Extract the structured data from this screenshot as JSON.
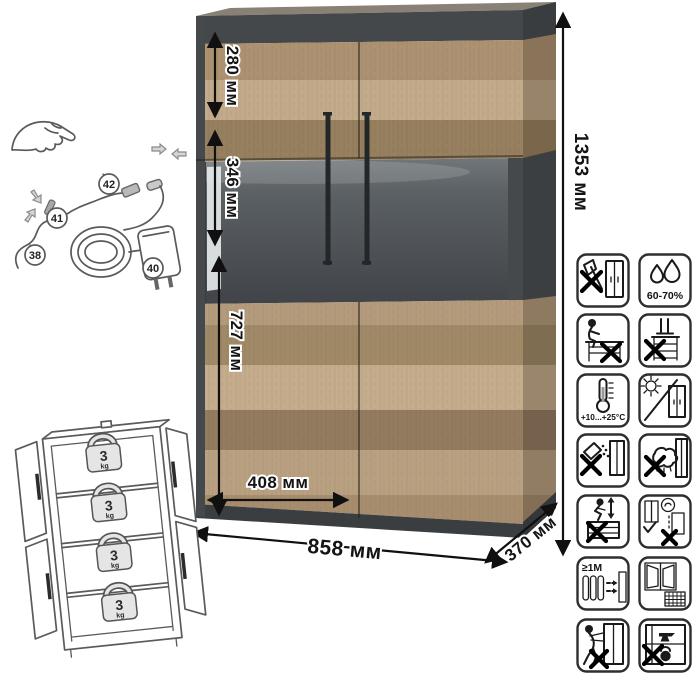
{
  "dimensions": {
    "top_section_height": "280 мм",
    "display_section_height": "346 мм",
    "lower_section_height": "727 мм",
    "door_width": "408 мм",
    "total_width": "858 мм",
    "depth": "370 мм",
    "total_height": "1353 мм"
  },
  "led_kit": {
    "callout_38": "38",
    "callout_40": "40",
    "callout_41": "41",
    "callout_42": "42"
  },
  "shelf_load": {
    "value": "3",
    "unit": "kg"
  },
  "care_icons": {
    "labels": {
      "humidity": "60-70%",
      "temperature": "+10...+25°C",
      "heat_distance": "≥1M"
    },
    "names": [
      "no-sharp-tools",
      "humidity-range",
      "no-sitting",
      "no-standing",
      "temperature-range",
      "avoid-direct-sunlight",
      "no-abrasive-cleaners",
      "no-wet-cloth",
      "no-jumping",
      "wall-mount-properly",
      "keep-distance-from-heater",
      "ventilate-room",
      "no-dragging",
      "no-heavy-items-inside"
    ]
  }
}
